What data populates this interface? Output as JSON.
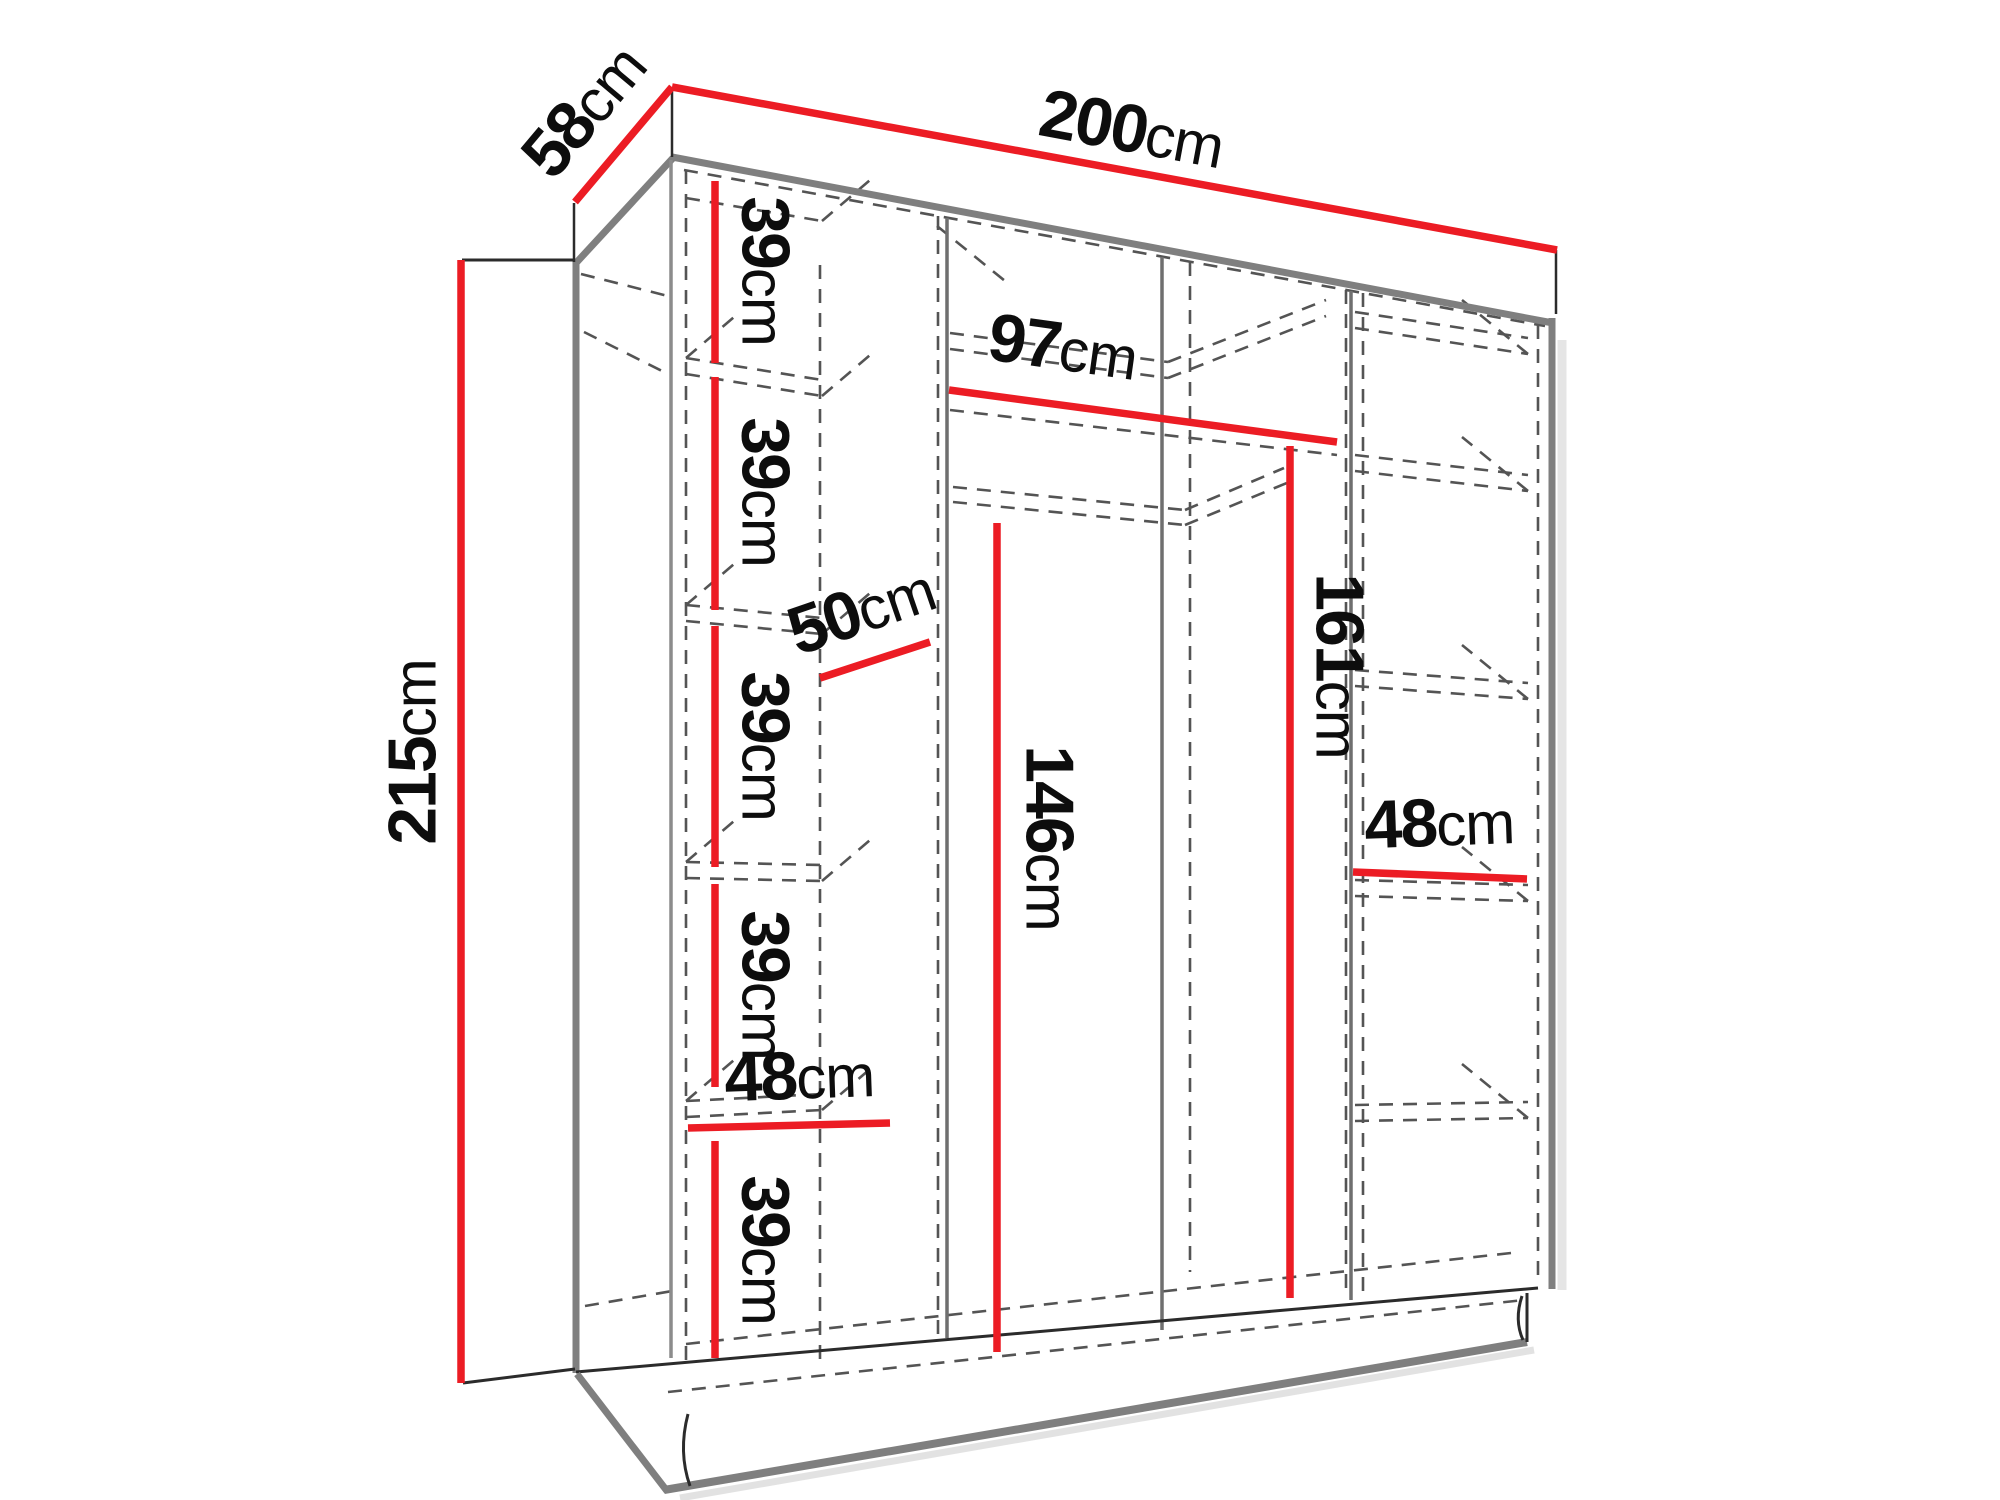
{
  "page": {
    "background": "#ffffff"
  },
  "diagram": {
    "type": "furniture-dimension-diagram",
    "subject": "three-section wardrobe in perspective with shelf columns and hanging rail",
    "colors": {
      "dimension_line": "#ec1c24",
      "outline": "#7f7f7f",
      "hidden_line": "#545454",
      "label_text": "#0d0d0d",
      "background": "#ffffff"
    },
    "dimensions": {
      "depth": {
        "value": "58",
        "unit": "cm"
      },
      "width": {
        "value": "200",
        "unit": "cm"
      },
      "height": {
        "value": "215",
        "unit": "cm"
      },
      "left_gap_1": {
        "value": "39",
        "unit": "cm"
      },
      "left_gap_2": {
        "value": "39",
        "unit": "cm"
      },
      "left_gap_3": {
        "value": "39",
        "unit": "cm"
      },
      "left_gap_4": {
        "value": "39",
        "unit": "cm"
      },
      "left_gap_5": {
        "value": "39",
        "unit": "cm"
      },
      "shelf_depth": {
        "value": "50",
        "unit": "cm"
      },
      "left_width": {
        "value": "48",
        "unit": "cm"
      },
      "hanging_width": {
        "value": "97",
        "unit": "cm"
      },
      "hanging_height_mid": {
        "value": "146",
        "unit": "cm"
      },
      "hanging_height_right": {
        "value": "161",
        "unit": "cm"
      },
      "right_width": {
        "value": "48",
        "unit": "cm"
      }
    }
  }
}
